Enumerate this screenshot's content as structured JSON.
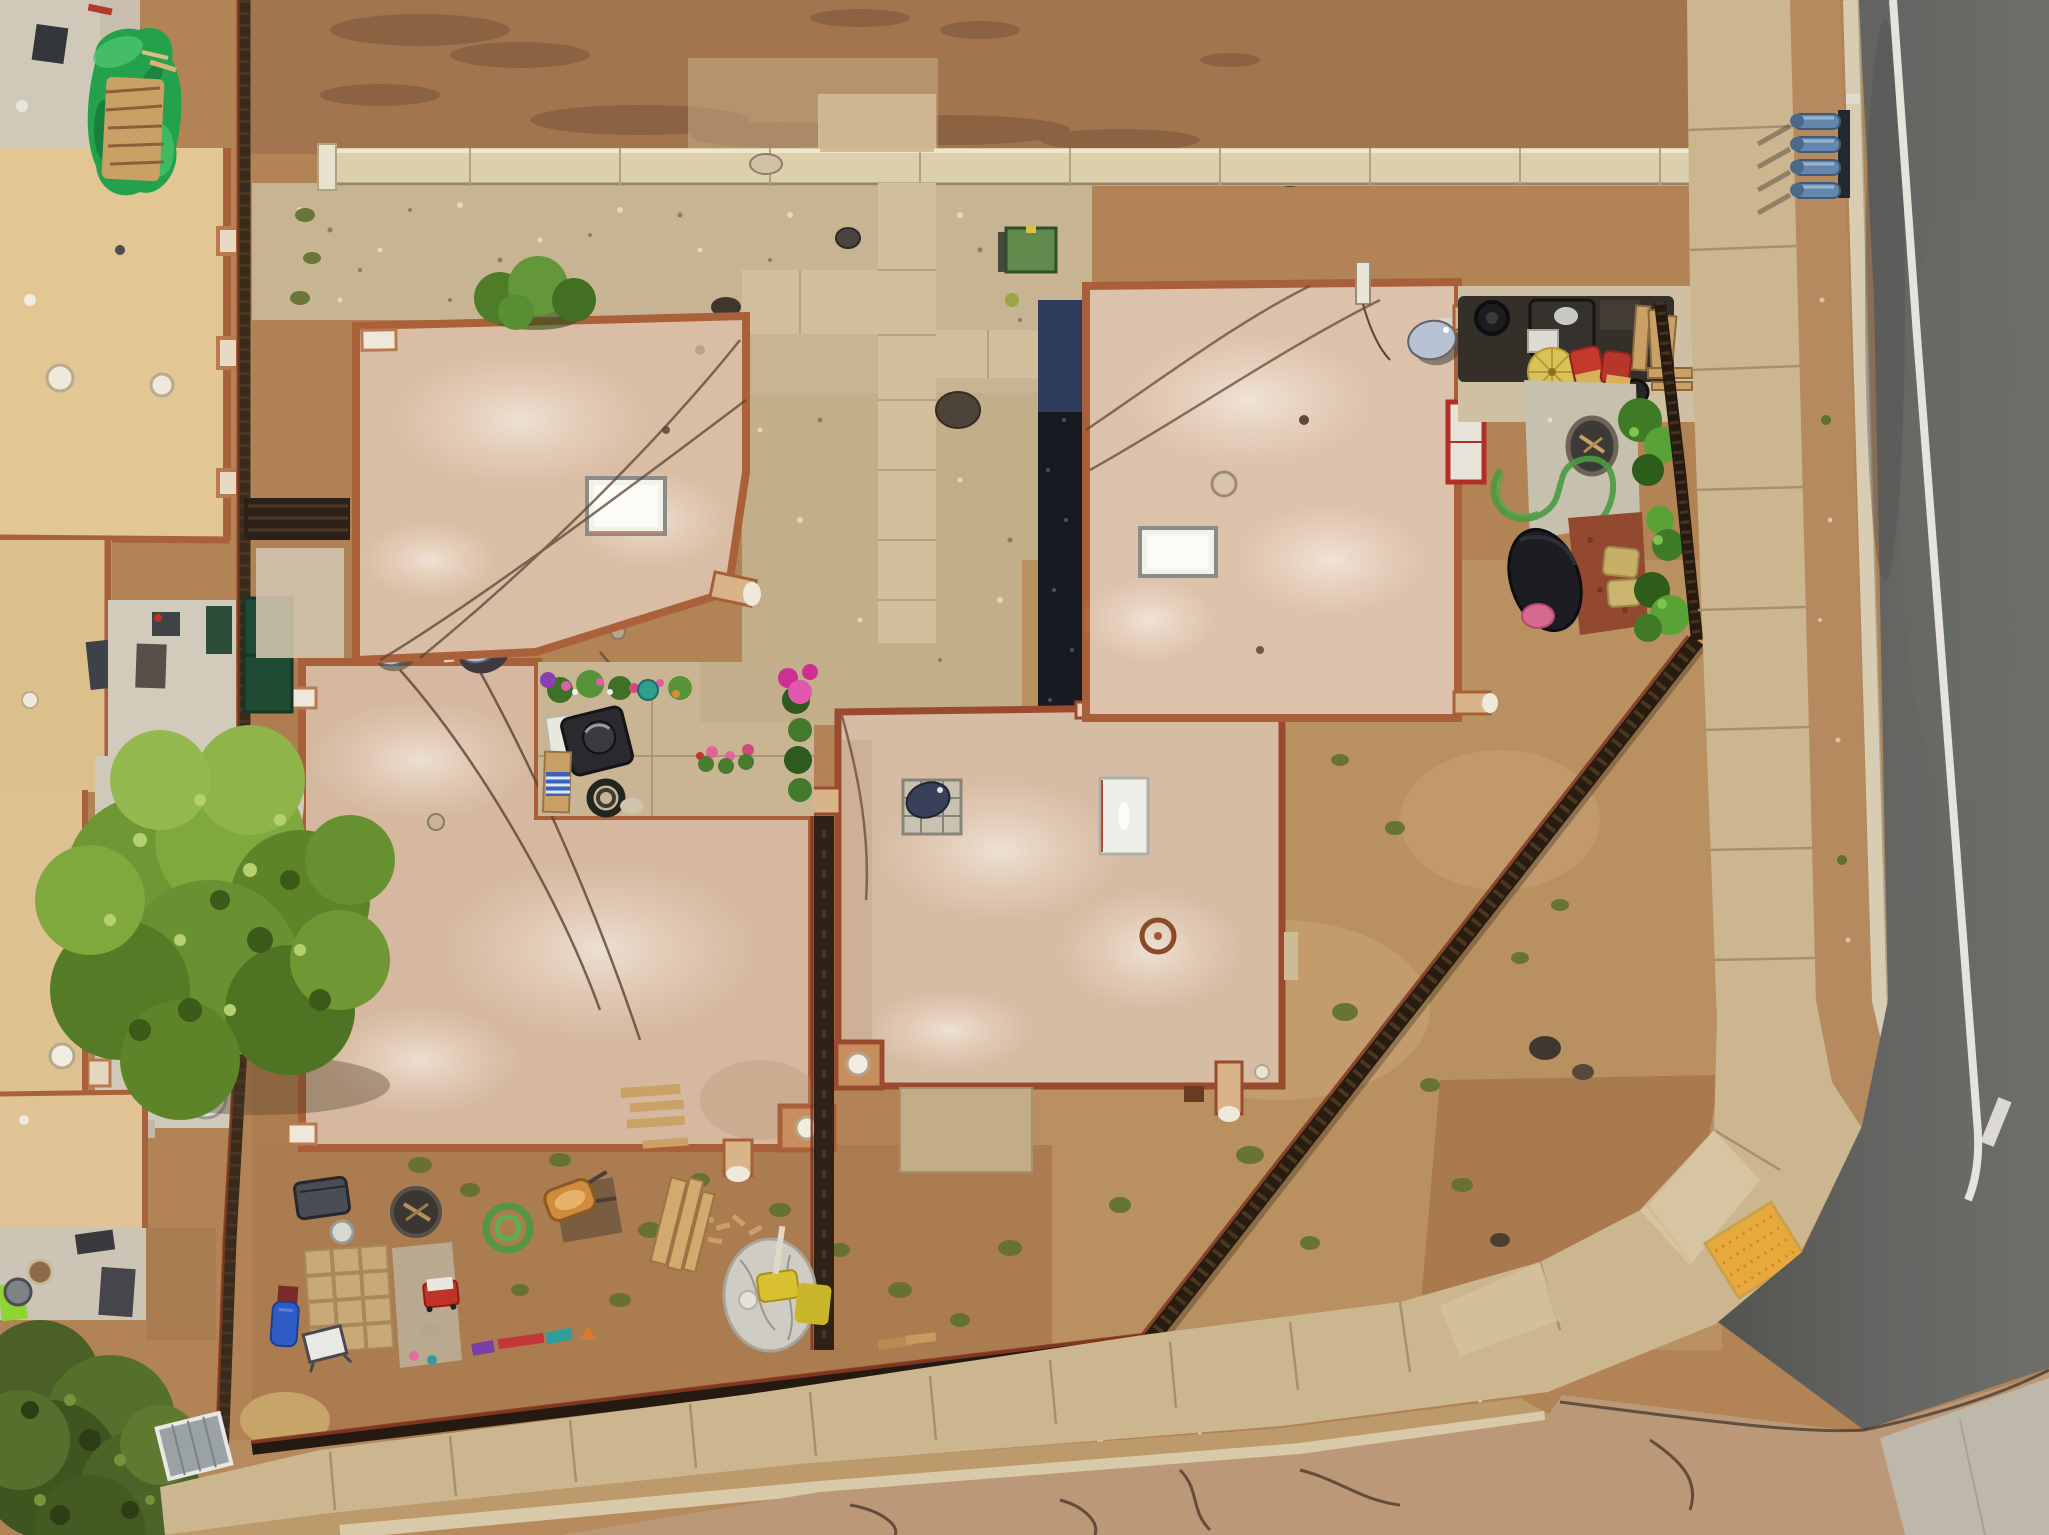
{
  "meta": {
    "kind": "aerial-drone-photograph",
    "description": "Top-down drone view of a corner residential lot with four flat-roofed adobe-style buildings, dirt and gravel yards, a backyard garden, coyote fences, a curved corner sidewalk with yellow curb, and an asphalt road on the right."
  },
  "palette": {
    "dirt_base": "#b28354",
    "dirt_top": "#a3754e",
    "dirt_se": "#b9905f",
    "dirt_sw": "#ab7c4f",
    "gravel": "#c7b493",
    "gravel2": "#c3ae8a",
    "walkway": "#d2bf9c",
    "wall": "#dccfae",
    "sidewalk": "#ccb68f",
    "parkway": "#b48a5e",
    "curb": "#d8cdb2",
    "curb_yellow": "#e0b83a",
    "tactile": "#e8a93c",
    "road_new": "#5f605e",
    "road_old": "#bb9877",
    "road_line": "#eceae2",
    "apron": "#bdb8a9",
    "roof_main": "#d9bda4",
    "roof_d": "#d5b89f",
    "roof_c": "#d7bca4",
    "roof_b": "#dcc1ab",
    "roof_trim": "#a9603a",
    "roof_trim_red": "#9a4a2e",
    "skylight": "#f2f1ea",
    "neighbor_roof": "#e2c694",
    "neighbor_roof2": "#dcc08c",
    "neighbor_patio": "#d0c9ba",
    "dark_strip": "#171a20",
    "dark_strip_navy": "#31405f",
    "fence_dark": "#3a2a1b",
    "fence_red": "#7e2f1d",
    "tarp_green": "#23a24b",
    "firewood": "#c9a166",
    "tree_green": "#6f9834",
    "tree_dark": "#4c5f26",
    "bush_green": "#4e7c28",
    "weed_olive": "#5f7030",
    "dish": "#b7c3d2",
    "dish_navy": "#39405a",
    "pipe_blue": "#6487ad",
    "mulch_red": "#92492f",
    "slab": "#c2ad87",
    "hose_green": "#4a9a40",
    "utility_box": "#5f8a4b",
    "umbrella_yellow": "#d9c257",
    "pillow_red": "#c23a2c",
    "pillow_gold": "#c6b068",
    "hammock": "#1c1c22",
    "hammock_pillow": "#d66a8e",
    "wagon_red": "#c23327",
    "slide_blue": "#2f5cc4",
    "tarp_gray": "#cfccc4"
  },
  "scene": {
    "buildings": [
      {
        "id": "house-top-left",
        "roof": "tan stucco",
        "features": [
          "skylight",
          "two satellite dishes",
          "canale drain",
          "bush at north parapet"
        ]
      },
      {
        "id": "house-middle-left",
        "roof": "tan stucco L-shape",
        "features": [
          "parapet pillars with white caps",
          "dome vent",
          "canale drain"
        ]
      },
      {
        "id": "house-center",
        "roof": "tan stucco",
        "features": [
          "portrait skylight",
          "navy satellite dish on platform",
          "dome vent",
          "canale drains",
          "rust vent ring"
        ]
      },
      {
        "id": "house-top-right",
        "roof": "tan stucco",
        "features": [
          "skylight",
          "satellite dish",
          "canale drains",
          "red-framed pad"
        ]
      },
      {
        "id": "neighbor-buildings-west",
        "roof": "yellow-tan",
        "features": [
          "dome vents",
          "concrete patios",
          "patio furniture"
        ]
      }
    ],
    "yard_items": [
      "green tarp over firewood pile",
      "green utility box",
      "garden grill equipment row",
      "yellow umbrella",
      "red and gold pillows",
      "fire pit",
      "green garden hose",
      "red mulch bed",
      "hammock with pink pillow",
      "trash bin",
      "wheelbarrow",
      "paver grid",
      "red wagon",
      "blue slide",
      "whiteboard",
      "toy row",
      "gray tarp pile",
      "lumber",
      "solar shed panel"
    ],
    "landscape": [
      "large green tree",
      "dark olive corner tree",
      "scattered olive weeds",
      "gravel beds",
      "dirt lots"
    ],
    "infrastructure": [
      "perimeter wall",
      "coyote fences",
      "concrete walk cross",
      "corner sidewalk with ADA tactile mat",
      "yellow painted curb",
      "asphalt road with white edge line",
      "older cross-street pavement",
      "blue utility pipe stubs"
    ]
  }
}
